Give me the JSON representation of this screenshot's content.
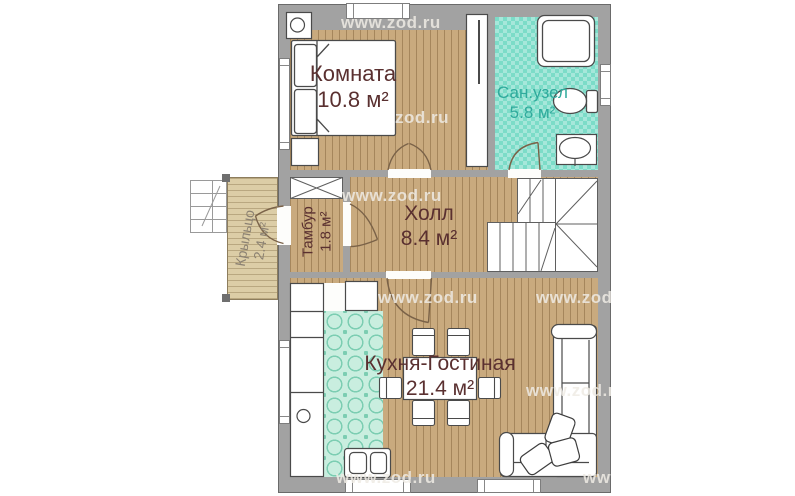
{
  "plan": {
    "type": "floor-plan",
    "language": "ru",
    "rooms": [
      {
        "id": "bedroom",
        "name": "Комната",
        "area": "10.8 м²"
      },
      {
        "id": "bathroom",
        "name": "Сан.узел",
        "area": "5.8 м²"
      },
      {
        "id": "hall",
        "name": "Холл",
        "area": "8.4 м²"
      },
      {
        "id": "tambour",
        "name": "Тамбур",
        "area": "1.8 м²"
      },
      {
        "id": "porch",
        "name": "Крыльцо",
        "area": "2.4 м²"
      },
      {
        "id": "kitchen_living",
        "name": "Кухня-Гостиная",
        "area": "21.4 м²"
      }
    ],
    "fixtures": [
      "bed",
      "nightstand",
      "wardrobe",
      "shower",
      "toilet",
      "sink",
      "closet",
      "winder-stairs",
      "kitchen-counter",
      "kitchen-sink",
      "fridge",
      "stove",
      "dining-table",
      "six-chairs",
      "corner-sofa",
      "pillows",
      "porch-steps"
    ]
  },
  "rooms_by_id": {
    "bedroom": {
      "name": "Комната",
      "area": "10.8 м²"
    },
    "bathroom": {
      "name": "Сан.узел",
      "area": "5.8 м²"
    },
    "hall": {
      "name": "Холл",
      "area": "8.4 м²"
    },
    "tambour": {
      "name": "Тамбур",
      "area": "1.8 м²"
    },
    "porch": {
      "name": "Крыльцо",
      "area": "2.4 м²"
    },
    "kitchen_living": {
      "name": "Кухня-Гостиная",
      "area": "21.4 м²"
    }
  },
  "watermarks": [
    {
      "text": "www.zod.ru"
    },
    {
      "text": "zod.ru"
    },
    {
      "text": "www.zod.ru"
    },
    {
      "text": "www.zod.ru"
    },
    {
      "text": "www.zod.ru"
    },
    {
      "text": "www.zod.ru"
    },
    {
      "text": "www.zod.ru"
    },
    {
      "text": "www.zod.ru"
    }
  ],
  "colors": {
    "wall": "#a2a2a2",
    "wood_floor": "#c9aa7e",
    "bath_tile": "#7cdcc8",
    "kitchen_tile": "#c9eedf",
    "porch_deck": "#dccda6",
    "label_main": "#5a3030",
    "label_bath": "#2faa9c",
    "label_porch": "#8b8172",
    "watermark": "#eeebe4"
  }
}
